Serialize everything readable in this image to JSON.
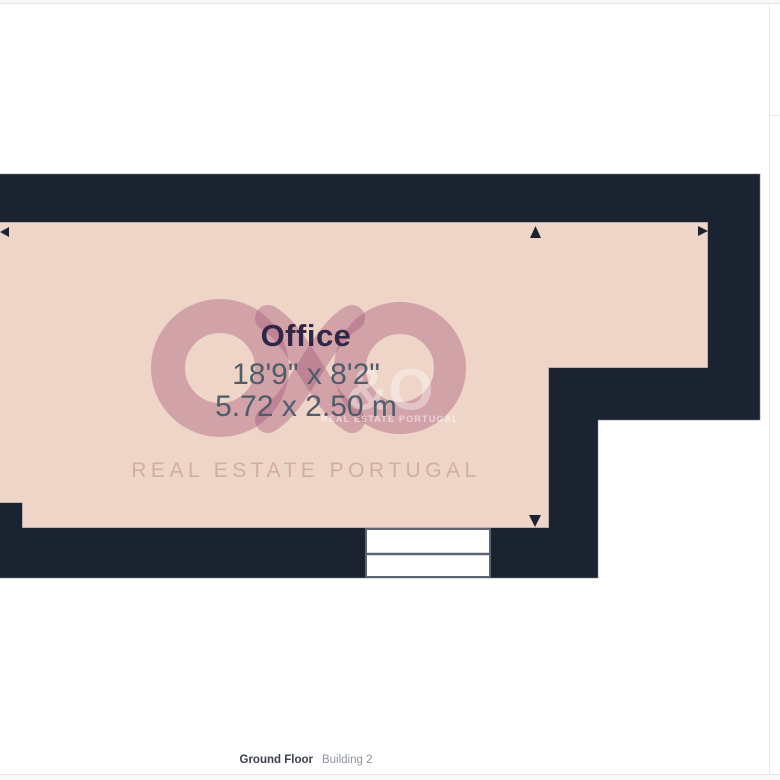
{
  "floorplan": {
    "room": {
      "name": "Office",
      "dimensions_imperial": "18'9\" x 8'2\"",
      "dimensions_metric": "5.72 x 2.50 m"
    },
    "watermark": {
      "brand_text": "REAL ESTATE PORTUGAL",
      "mini_glyph": "&O",
      "mini_brand_text": "REAL ESTATE PORTUGAL"
    },
    "icons": [
      "dimension-arrow-left-icon",
      "dimension-arrow-right-icon",
      "dimension-arrow-up-icon",
      "dimension-arrow-down-icon",
      "infinity-rings-logo-icon"
    ],
    "colors": {
      "wall": "#1c2330",
      "room_fill": "#eed5c7",
      "room_outline": "#8c8c94",
      "watermark_mauve": "#a4567a",
      "room_name_text": "#302645",
      "dimension_text": "#4f5c6a",
      "window_frame": "#5e6571",
      "footer_floor_text": "#39414f",
      "footer_building_text": "#8d95a1"
    }
  },
  "footer": {
    "floor_label": "Ground Floor",
    "building_label": "Building 2"
  }
}
